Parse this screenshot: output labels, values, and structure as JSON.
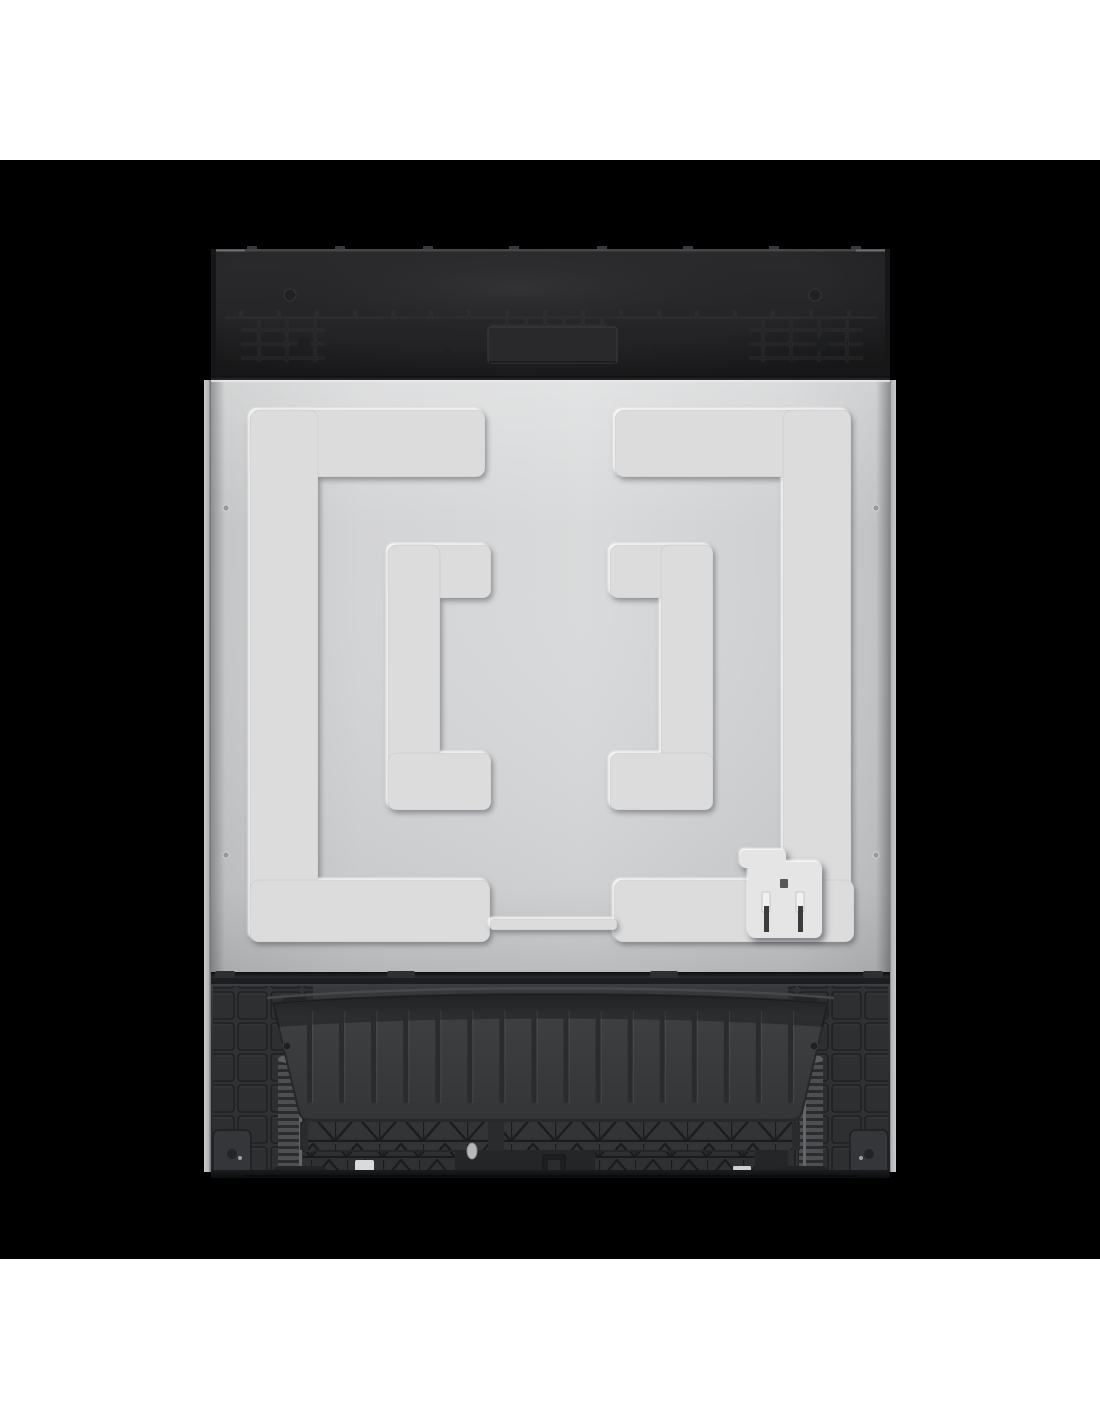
{
  "image": {
    "kind": "product-photo",
    "subject": "dishwasher-rear-view"
  },
  "colors": {
    "page_background": "#ffffff",
    "matte_background": "#000000",
    "top_panel_dark": "#252527",
    "steel_panel_gray": "#d4d5d6",
    "embossed_ridge": "#dcdcdd",
    "plastic_base_dark": "#2c2d2f",
    "outlet_boss": "#e5e5e6"
  },
  "top_panel": {
    "ticks_x": [
      44,
      132,
      220,
      306,
      394,
      480,
      566,
      648
    ]
  },
  "base": {
    "rib_count": 16,
    "rib_x_start": 104,
    "rib_x_end": 585,
    "rib_y": 765,
    "rib_h": 92,
    "rib_w": 5
  }
}
